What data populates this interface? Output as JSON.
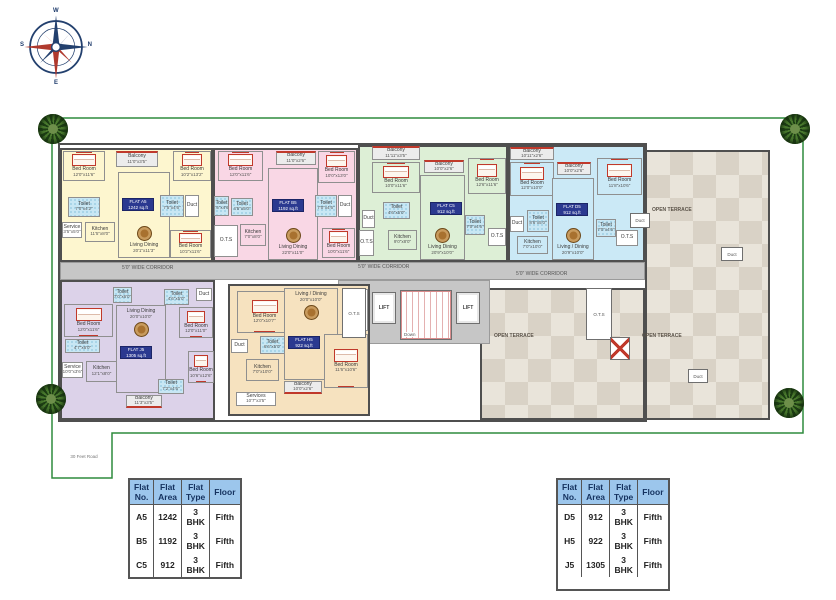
{
  "compass": {
    "w": "W",
    "n": "N",
    "e": "E",
    "s": "S"
  },
  "road_label": "30 Feet Road",
  "corridor": {
    "label": "5'0\" WIDE CORRIDOR",
    "positions": [
      [
        122,
        265
      ],
      [
        358,
        264
      ],
      [
        516,
        271
      ]
    ]
  },
  "terrace": {
    "label": "OPEN TERRACE",
    "positions": [
      [
        652,
        207
      ],
      [
        494,
        333
      ],
      [
        642,
        333
      ]
    ]
  },
  "central_boxes": [
    {
      "t": "O.T.S",
      "type": "ots",
      "b": [
        342,
        288,
        24,
        50
      ]
    },
    {
      "t": "LIFT",
      "type": "lift",
      "b": [
        372,
        292,
        24,
        32
      ]
    },
    {
      "t": "Down",
      "type": "stair",
      "b": [
        400,
        290,
        52,
        50
      ]
    },
    {
      "t": "LIFT",
      "type": "lift",
      "b": [
        456,
        292,
        24,
        32
      ]
    },
    {
      "t": "O.T.S",
      "type": "ots",
      "b": [
        586,
        288,
        26,
        52
      ]
    },
    {
      "t": "",
      "type": "fire",
      "b": [
        610,
        337,
        20,
        23
      ]
    },
    {
      "t": "Duct",
      "type": "duct",
      "b": [
        630,
        213,
        20,
        15
      ]
    },
    {
      "t": "Duct",
      "type": "duct",
      "b": [
        721,
        247,
        22,
        14
      ]
    },
    {
      "t": "Duct",
      "type": "duct",
      "b": [
        688,
        369,
        20,
        14
      ]
    }
  ],
  "flats": [
    {
      "id": "A5",
      "label": "FLAT A5",
      "area": "1242 sq.ft",
      "color": "#fdf6cf",
      "box": [
        60,
        148,
        153,
        114
      ],
      "label_pos": [
        122,
        198
      ],
      "rooms": [
        {
          "n": "Bed Room",
          "d": "12'0\"x11'6\"",
          "t": "bed",
          "b": [
            63,
            151,
            42,
            30
          ]
        },
        {
          "n": "Balcony",
          "d": "11'0\"x3'5\"",
          "t": "balc",
          "b": [
            116,
            151,
            42,
            16
          ]
        },
        {
          "n": "Bed Room",
          "d": "10'2\"x13'2\"",
          "t": "bed",
          "b": [
            173,
            151,
            38,
            30
          ]
        },
        {
          "n": "Toilet",
          "d": "7'0\"x4'2\"",
          "t": "bath",
          "b": [
            68,
            197,
            32,
            20
          ]
        },
        {
          "n": "Service",
          "d": "3'5\"x5'0\"",
          "t": "serv",
          "b": [
            62,
            222,
            20,
            16
          ]
        },
        {
          "n": "Kitchen",
          "d": "11'5\"x8'0\"",
          "t": "kitch",
          "b": [
            85,
            222,
            30,
            20
          ]
        },
        {
          "n": "Living Dining",
          "d": "20'1\"x11'3\"",
          "t": "living",
          "lp": "b",
          "b": [
            118,
            172,
            52,
            86
          ]
        },
        {
          "n": "Toilet",
          "d": "7'5\"x4'6\"",
          "t": "bath",
          "b": [
            160,
            195,
            24,
            22
          ]
        },
        {
          "n": "Duct",
          "d": "",
          "t": "duct2",
          "b": [
            185,
            195,
            14,
            22
          ]
        },
        {
          "n": "Bed Room",
          "d": "10'2\"x11'6\"",
          "t": "bed",
          "b": [
            170,
            230,
            41,
            28
          ]
        }
      ]
    },
    {
      "id": "B5",
      "label": "FLAT B5",
      "area": "1192 sq.ft",
      "color": "#f9d7e5",
      "box": [
        213,
        148,
        145,
        114
      ],
      "label_pos": [
        272,
        199
      ],
      "rooms": [
        {
          "n": "Bed Room",
          "d": "12'0\"x11'6\"",
          "t": "bed",
          "b": [
            218,
            151,
            45,
            30
          ]
        },
        {
          "n": "Balcony",
          "d": "11'0\"x2'6\"",
          "t": "balc",
          "b": [
            276,
            151,
            40,
            14
          ]
        },
        {
          "n": "Bed Room",
          "d": "10'0\"x13'0\"",
          "t": "bed",
          "b": [
            318,
            151,
            37,
            32
          ]
        },
        {
          "n": "Toilet",
          "d": "4'5\"x4'6\"",
          "t": "bath",
          "b": [
            214,
            196,
            15,
            20
          ]
        },
        {
          "n": "Toilet",
          "d": "4'5\"x5'0\"",
          "t": "bath",
          "b": [
            231,
            198,
            22,
            18
          ]
        },
        {
          "n": "O.T.S",
          "d": "",
          "t": "ots2",
          "b": [
            214,
            225,
            24,
            32
          ]
        },
        {
          "n": "Kitchen",
          "d": "7'0\"x8'0\"",
          "t": "kitch",
          "b": [
            240,
            224,
            26,
            22
          ]
        },
        {
          "n": "Living Dining",
          "d": "22'0\"x11'0\"",
          "t": "living",
          "lp": "b",
          "b": [
            268,
            168,
            50,
            92
          ]
        },
        {
          "n": "Toilet",
          "d": "7'0\"x4'6\"",
          "t": "bath",
          "b": [
            315,
            195,
            22,
            22
          ]
        },
        {
          "n": "Duct",
          "d": "",
          "t": "duct2",
          "b": [
            338,
            195,
            14,
            22
          ]
        },
        {
          "n": "Bed Room",
          "d": "10'0\"x11'6\"",
          "t": "bed",
          "b": [
            322,
            228,
            33,
            30
          ]
        }
      ]
    },
    {
      "id": "C5",
      "label": "FLAT C5",
      "area": "912 sq.ft",
      "color": "#ddefd6",
      "box": [
        358,
        145,
        150,
        117
      ],
      "label_pos": [
        430,
        202
      ],
      "rooms": [
        {
          "n": "Balcony",
          "d": "11'11\"x3'5\"",
          "t": "balc",
          "b": [
            372,
            146,
            48,
            14
          ]
        },
        {
          "n": "Bed Room",
          "d": "10'0\"x11'6\"",
          "t": "bed",
          "b": [
            372,
            162,
            48,
            31
          ]
        },
        {
          "n": "Balcony",
          "d": "10'0\"x2'6\"",
          "t": "balc",
          "b": [
            424,
            160,
            40,
            13
          ]
        },
        {
          "n": "Bed Room",
          "d": "12'6\"x11'6\"",
          "t": "bed",
          "b": [
            468,
            158,
            38,
            36
          ]
        },
        {
          "n": "Duct",
          "d": "",
          "t": "duct2",
          "b": [
            362,
            210,
            13,
            18
          ]
        },
        {
          "n": "Toilet",
          "d": "4'6\"x5'0\"",
          "t": "bath",
          "b": [
            383,
            202,
            27,
            17
          ]
        },
        {
          "n": "O.T.S",
          "d": "",
          "t": "ots2",
          "b": [
            359,
            230,
            15,
            26
          ]
        },
        {
          "n": "Kitchen",
          "d": "9'0\"x8'0\"",
          "t": "kitch",
          "b": [
            388,
            230,
            29,
            20
          ]
        },
        {
          "n": "Living Dining",
          "d": "20'9\"x10'0\"",
          "t": "living",
          "lp": "b",
          "b": [
            420,
            175,
            45,
            85
          ]
        },
        {
          "n": "Toilet",
          "d": "7'0\"x4'6\"",
          "t": "bath",
          "b": [
            465,
            215,
            20,
            20
          ]
        },
        {
          "n": "O.T.S",
          "d": "",
          "t": "ots2",
          "b": [
            488,
            228,
            18,
            18
          ]
        }
      ]
    },
    {
      "id": "D5",
      "label": "FLAT D5",
      "area": "912 sq.ft",
      "color": "#cbe9f6",
      "box": [
        508,
        145,
        137,
        117
      ],
      "label_pos": [
        556,
        203
      ],
      "rooms": [
        {
          "n": "Balcony",
          "d": "10'11\"x2'6\"",
          "t": "balc",
          "b": [
            510,
            147,
            44,
            13
          ]
        },
        {
          "n": "Bed Room",
          "d": "12'0\"x10'0\"",
          "t": "bed",
          "b": [
            510,
            162,
            44,
            34
          ]
        },
        {
          "n": "Balcony",
          "d": "10'0\"x2'6\"",
          "t": "balc",
          "b": [
            557,
            162,
            34,
            13
          ]
        },
        {
          "n": "Bed Room",
          "d": "11'8\"x10'6\"",
          "t": "bed",
          "b": [
            597,
            158,
            45,
            37
          ]
        },
        {
          "n": "Duct",
          "d": "",
          "t": "duct2",
          "b": [
            510,
            216,
            14,
            16
          ]
        },
        {
          "n": "Toilet",
          "d": "8'6\"x5'0\"",
          "t": "bath",
          "b": [
            527,
            210,
            22,
            22
          ]
        },
        {
          "n": "Kitchen",
          "d": "7'0\"x10'0\"",
          "t": "kitch",
          "b": [
            517,
            236,
            31,
            18
          ]
        },
        {
          "n": "Living / Dining",
          "d": "20'9\"x10'0\"",
          "t": "living",
          "lp": "b",
          "b": [
            552,
            178,
            42,
            82
          ]
        },
        {
          "n": "Toilet",
          "d": "7'0\"x4'6\"",
          "t": "bath",
          "b": [
            596,
            219,
            20,
            18
          ]
        },
        {
          "n": "O.T.S",
          "d": "",
          "t": "ots2",
          "b": [
            616,
            230,
            22,
            16
          ]
        }
      ]
    },
    {
      "id": "J5",
      "label": "FLAT J5",
      "area": "1305 sq.ft",
      "color": "#dcd2e9",
      "box": [
        60,
        280,
        155,
        140
      ],
      "label_pos": [
        120,
        346
      ],
      "rooms": [
        {
          "n": "Toilet",
          "d": "7'0\"x6'0\"",
          "t": "bath",
          "b": [
            113,
            287,
            19,
            16
          ]
        },
        {
          "n": "Toilet",
          "d": "4'6\"x5'0\"",
          "t": "bath",
          "b": [
            164,
            289,
            25,
            16
          ]
        },
        {
          "n": "Duct",
          "d": "",
          "t": "duct2",
          "b": [
            196,
            288,
            16,
            13
          ]
        },
        {
          "n": "Living Dining",
          "d": "20'0\"x10'0\"",
          "t": "living",
          "lp": "t",
          "b": [
            116,
            305,
            50,
            88
          ]
        },
        {
          "n": "Bed Room",
          "d": "12'0\"x11'6\"",
          "t": "bed",
          "b": [
            64,
            304,
            49,
            33
          ]
        },
        {
          "n": "Toilet",
          "d": "4'7\"x6'0\"",
          "t": "bath",
          "b": [
            65,
            339,
            35,
            14
          ]
        },
        {
          "n": "Bed Room",
          "d": "12'0\"x11'0\"",
          "t": "bed",
          "b": [
            179,
            307,
            34,
            31
          ]
        },
        {
          "n": "Service",
          "d": "10'0\"x3'6\"",
          "t": "serv",
          "b": [
            62,
            362,
            21,
            16
          ]
        },
        {
          "n": "Kitchen",
          "d": "12'1\"x8'0\"",
          "t": "kitch",
          "b": [
            86,
            361,
            31,
            21
          ]
        },
        {
          "n": "Bed Room",
          "d": "10'6\"x12'6\"",
          "t": "bed",
          "b": [
            188,
            351,
            26,
            32
          ]
        },
        {
          "n": "Toilet",
          "d": "7'2\"x4'6\"",
          "t": "bath",
          "b": [
            158,
            379,
            26,
            15
          ]
        },
        {
          "n": "Balcony",
          "d": "11'3\"x3'5\"",
          "t": "balc",
          "b": [
            126,
            395,
            36,
            13
          ]
        }
      ]
    },
    {
      "id": "H5",
      "label": "FLAT H5",
      "area": "922 sq.ft",
      "color": "#f6e2bf",
      "box": [
        228,
        284,
        142,
        132
      ],
      "label_pos": [
        288,
        336
      ],
      "rooms": [
        {
          "n": "Bed Room",
          "d": "12'0\"x10'7\"",
          "t": "bed",
          "b": [
            237,
            291,
            55,
            42
          ]
        },
        {
          "n": "Living / Dining",
          "d": "20'0\"x10'0\"",
          "t": "living",
          "lp": "t",
          "b": [
            284,
            288,
            54,
            92
          ]
        },
        {
          "n": "O.T.S",
          "d": "",
          "t": "ots2",
          "b": [
            342,
            289,
            26,
            42
          ]
        },
        {
          "n": "Duct",
          "d": "",
          "t": "duct2",
          "b": [
            231,
            339,
            17,
            14
          ]
        },
        {
          "n": "Toilet",
          "d": "6'6\"x5'0\"",
          "t": "bath",
          "b": [
            260,
            336,
            25,
            18
          ]
        },
        {
          "n": "Bed Room",
          "d": "11'6\"x10'6\"",
          "t": "bed",
          "b": [
            324,
            334,
            44,
            54
          ]
        },
        {
          "n": "Kitchen",
          "d": "7'0\"x10'0\"",
          "t": "kitch",
          "b": [
            246,
            359,
            33,
            22
          ]
        },
        {
          "n": "Balcony",
          "d": "10'0\"x2'6\"",
          "t": "balc",
          "b": [
            284,
            381,
            38,
            13
          ]
        },
        {
          "n": "Services",
          "d": "10'7\"x3'5\"",
          "t": "serv",
          "b": [
            236,
            392,
            40,
            14
          ]
        }
      ]
    }
  ],
  "tables": [
    {
      "pos": [
        128,
        478
      ],
      "headers": [
        "Flat No.",
        "Flat Area",
        "Flat Type",
        "Floor"
      ],
      "rows": [
        [
          "A5",
          "1242",
          "3 BHK",
          "Fifth"
        ],
        [
          "B5",
          "1192",
          "3 BHK",
          "Fifth"
        ],
        [
          "C5",
          "912",
          "3 BHK",
          "Fifth"
        ]
      ]
    },
    {
      "pos": [
        556,
        478
      ],
      "headers": [
        "Flat No.",
        "Flat Area",
        "Flat Type",
        "Floor"
      ],
      "rows": [
        [
          "D5",
          "912",
          "3 BHK",
          "Fifth"
        ],
        [
          "H5",
          "922",
          "3 BHK",
          "Fifth"
        ],
        [
          "J5",
          "1305",
          "3 BHK",
          "Fifth"
        ]
      ]
    }
  ],
  "colors": {
    "accent_navy": "#2b3990",
    "wall": "#4f4f4f",
    "red_accent": "#c0392b",
    "corridor_gray": "#c6c6c6",
    "table_header_blue": "#9cc6ec",
    "boundary_green": "#2e8b3d",
    "toilet_blue": "#c8e7f4",
    "flat_a5": "#fdf6cf",
    "flat_b5": "#f9d7e5",
    "flat_c5": "#ddefd6",
    "flat_d5": "#cbe9f6",
    "flat_j5": "#dcd2e9",
    "flat_h5": "#f6e2bf"
  }
}
